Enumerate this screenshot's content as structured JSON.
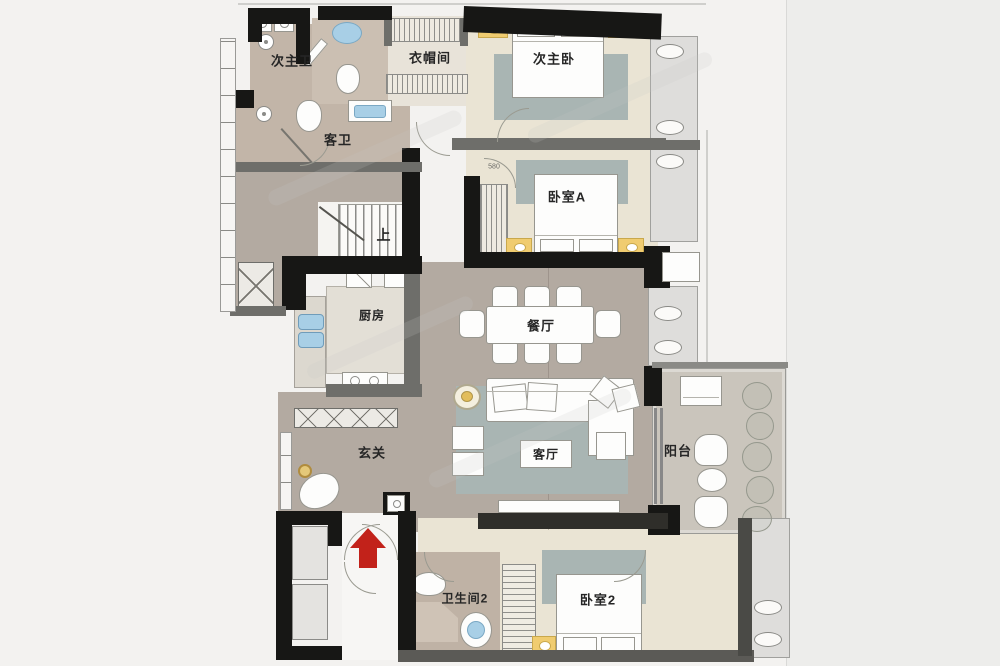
{
  "rooms": {
    "ensuite_bath": {
      "label": "次主卫"
    },
    "guest_bath": {
      "label": "客卫"
    },
    "cloakroom": {
      "label": "衣帽间"
    },
    "second_master_bedroom": {
      "label": "次主卧"
    },
    "bedroom_a": {
      "label": "卧室A"
    },
    "kitchen": {
      "label": "厨房"
    },
    "dining_room": {
      "label": "餐厅"
    },
    "entry": {
      "label": "玄关"
    },
    "living_room": {
      "label": "客厅"
    },
    "balcony": {
      "label": "阳台"
    },
    "bathroom_2": {
      "label": "卫生间2"
    },
    "bedroom_2": {
      "label": "卧室2"
    }
  },
  "annotations": {
    "stairs_up": "上",
    "dimension_580": "580"
  },
  "colors": {
    "wall": "#171715",
    "floor_hall": "#b3aaa1",
    "floor_bedroom": "#eae4d4",
    "floor_bath": "#c2b5a8",
    "rug": "#a9b5b3",
    "accent_pillow": "#f0cc70",
    "sink_blue": "#a8cfe6",
    "entrance_arrow": "#c2221a"
  }
}
